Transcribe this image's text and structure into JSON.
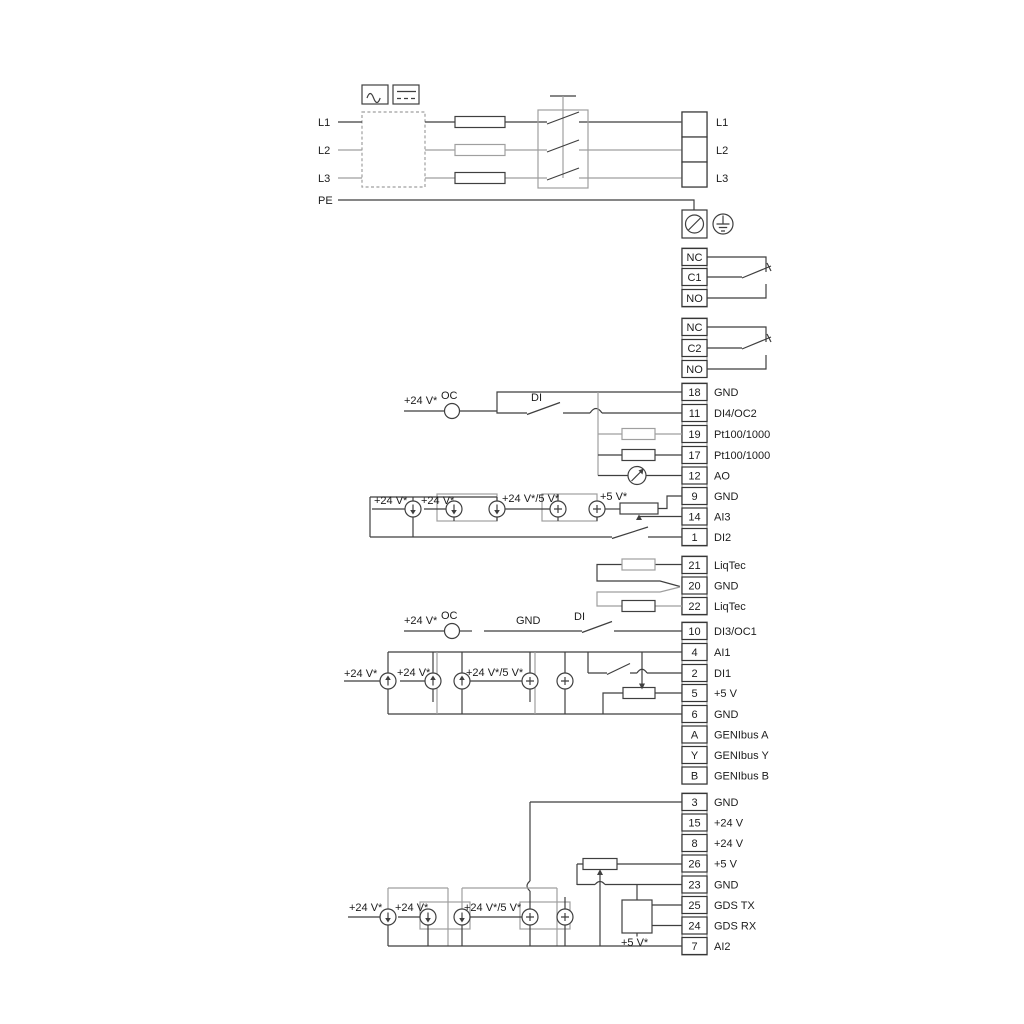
{
  "mains": {
    "left": [
      "L1",
      "L2",
      "L3"
    ],
    "pe": "PE",
    "right": [
      "L1",
      "L2",
      "L3"
    ]
  },
  "relays": {
    "r1": [
      "NC",
      "C1",
      "NO"
    ],
    "r2": [
      "NC",
      "C2",
      "NO"
    ]
  },
  "terminals": {
    "top": [
      {
        "n": "18",
        "l": "GND"
      },
      {
        "n": "11",
        "l": "DI4/OC2"
      },
      {
        "n": "19",
        "l": "Pt100/1000"
      },
      {
        "n": "17",
        "l": "Pt100/1000"
      },
      {
        "n": "12",
        "l": "AO"
      },
      {
        "n": "9",
        "l": "GND"
      },
      {
        "n": "14",
        "l": "AI3"
      },
      {
        "n": "1",
        "l": "DI2"
      }
    ],
    "liqtec": [
      {
        "n": "21",
        "l": "LiqTec"
      },
      {
        "n": "20",
        "l": "GND"
      },
      {
        "n": "22",
        "l": "LiqTec"
      }
    ],
    "mid": [
      {
        "n": "10",
        "l": "DI3/OC1"
      },
      {
        "n": "4",
        "l": "AI1"
      },
      {
        "n": "2",
        "l": "DI1"
      },
      {
        "n": "5",
        "l": "+5 V"
      },
      {
        "n": "6",
        "l": "GND"
      },
      {
        "n": "A",
        "l": "GENIbus A"
      },
      {
        "n": "Y",
        "l": "GENIbus Y"
      },
      {
        "n": "B",
        "l": "GENIbus B"
      }
    ],
    "bottom": [
      {
        "n": "3",
        "l": "GND"
      },
      {
        "n": "15",
        "l": "+24 V"
      },
      {
        "n": "8",
        "l": "+24 V"
      },
      {
        "n": "26",
        "l": "+5 V"
      },
      {
        "n": "23",
        "l": "GND"
      },
      {
        "n": "25",
        "l": "GDS TX"
      },
      {
        "n": "24",
        "l": "GDS RX"
      },
      {
        "n": "7",
        "l": "AI2"
      }
    ]
  },
  "labels": {
    "v24": "+24 V*",
    "v24_5": "+24 V*/5 V*",
    "v5": "+5 V*",
    "oc": "OC",
    "di": "DI",
    "gnd": "GND"
  },
  "colors": {
    "wire_dark": "#3f3f3f",
    "wire_gray": "#9f9f9f",
    "text": "#1c1c1c"
  }
}
